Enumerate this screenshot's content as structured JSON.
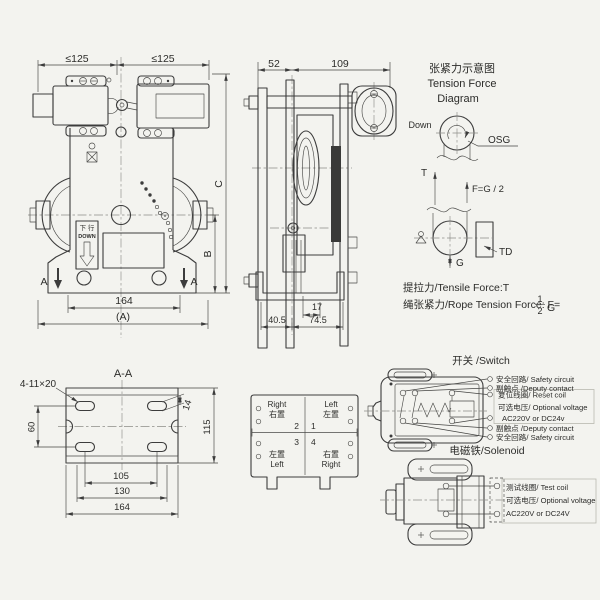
{
  "front_view": {
    "dim_top_left": "≤125",
    "dim_top_right": "≤125",
    "dim_bottom_inner": "164",
    "dim_bottom_outer": "(A)",
    "dim_height_outer": "C",
    "dim_height_inner": "B",
    "section_arrow_left": "A",
    "section_arrow_right": "A",
    "down_cn": "下 行",
    "down_en": "DOWN"
  },
  "side_view": {
    "dim_52": "52",
    "dim_109": "109",
    "dim_17": "17",
    "dim_40_5": "40.5",
    "dim_74_5": "74.5"
  },
  "tension": {
    "title_cn": "张紧力示意图",
    "title_en_1": "Tension Force",
    "title_en_2": "Diagram",
    "down_label": "Down",
    "osg_label": "OSG",
    "t_label": "T",
    "f_label": "F=G / 2",
    "g_label": "G",
    "td_label": "TD",
    "note_tensile": "提拉力/Tensile Force:T",
    "note_rope_prefix": "绳张紧力/Rope Tension Force: F=",
    "frac_num": "1",
    "frac_den": "2",
    "note_rope_suffix": "G"
  },
  "section_aa": {
    "title": "A-A",
    "slots_label": "4-11×20",
    "dim_60": "60",
    "dim_14": "14",
    "dim_115": "115",
    "dim_105": "105",
    "dim_130": "130",
    "dim_164": "164"
  },
  "terminals": {
    "tl_en": "Right",
    "tl_cn": "右置",
    "tr_en": "Left",
    "tr_cn": "左置",
    "bl_cn": "左置",
    "bl_en": "Left",
    "br_cn": "右置",
    "br_en": "Right",
    "num_1": "1",
    "num_2": "2",
    "num_3": "3",
    "num_4": "4"
  },
  "switch": {
    "title": "开关 /Switch",
    "label_safety_top": "安全回路/ Safety circuit",
    "label_deputy_top": "副触点 /Deputy contact",
    "label_reset": "复位线圈/ Reset coil",
    "label_voltage": "可选电压/ Optional voltage",
    "label_voltage_value": "AC220V or DC24v",
    "label_deputy_bottom": "副触点 /Deputy contact",
    "label_safety_bottom": "安全回路/ Safety circuit"
  },
  "solenoid": {
    "title": "电磁铁/Solenoid",
    "label_test_coil": "测试线圈/ Test coil",
    "label_voltage": "可选电压/ Optional voltage",
    "label_voltage_value": "AC220V  or  DC24V"
  }
}
